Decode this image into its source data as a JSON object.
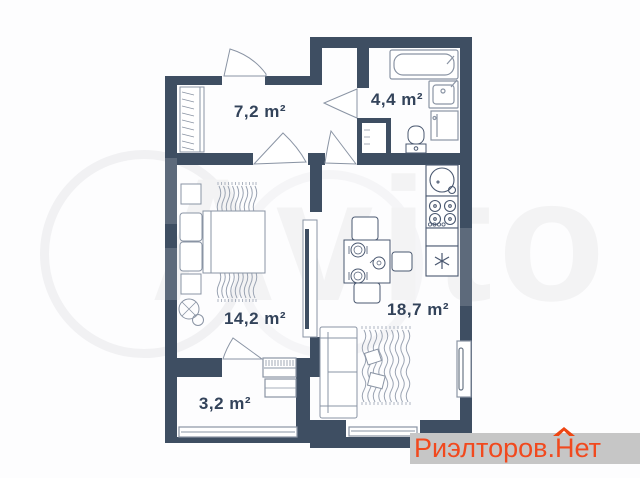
{
  "watermark": {
    "text": "Avito"
  },
  "rooms": [
    {
      "name": "hallway",
      "area": "7,2 m²"
    },
    {
      "name": "bathroom",
      "area": "4,4 m²"
    },
    {
      "name": "bedroom",
      "area": "14,2 m²"
    },
    {
      "name": "kitchen-living",
      "area": "18,7 m²"
    },
    {
      "name": "balcony",
      "area": "3,2 m²"
    }
  ],
  "logo": {
    "part1": "Риэлторов.",
    "part2": "Нет",
    "color": "#f1491e",
    "bg": "#c6c6c6"
  },
  "colors": {
    "wall": "#3e4e62",
    "furniture_line": "#8a94a4",
    "appliance_line": "#4a5870",
    "label": "#33435a"
  }
}
